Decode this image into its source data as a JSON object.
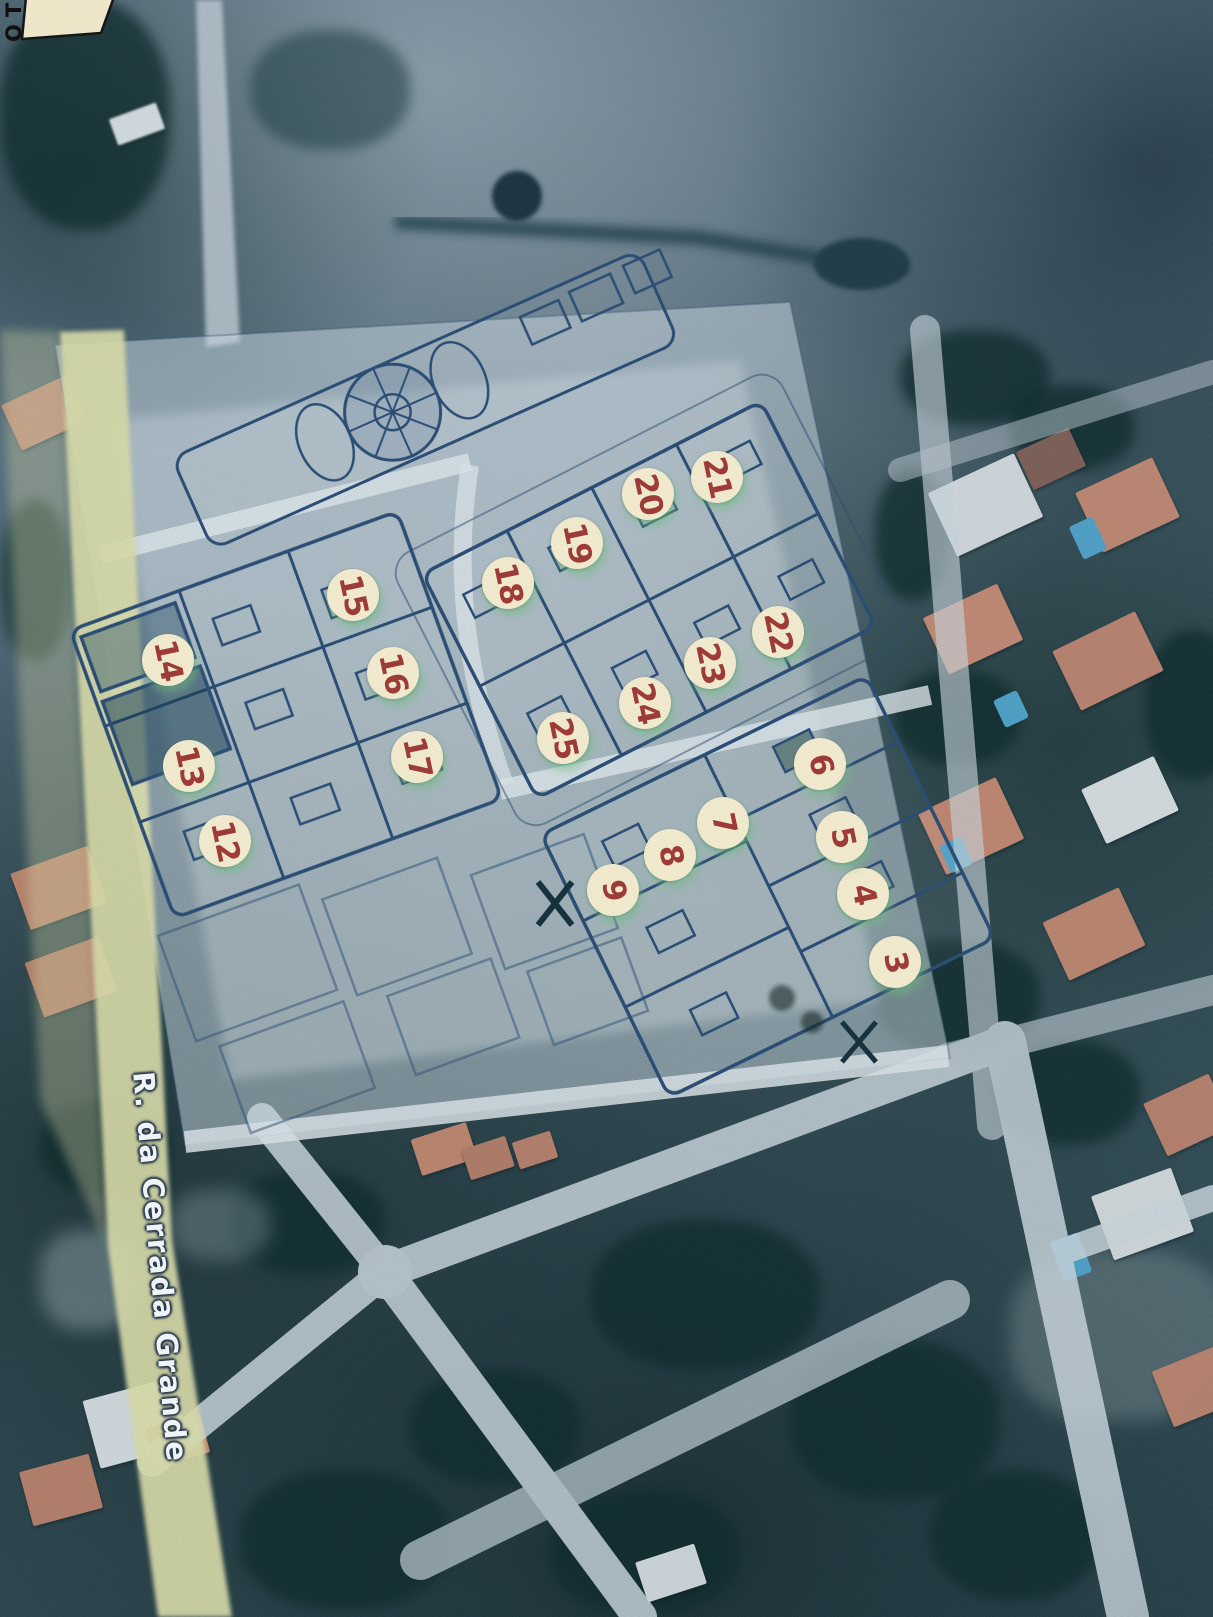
{
  "corner_label": {
    "text": "TO"
  },
  "street_label": {
    "text": "R. da Cerrada Grande"
  },
  "markers": [
    {
      "number": "3",
      "x": 895,
      "y": 962
    },
    {
      "number": "4",
      "x": 863,
      "y": 894
    },
    {
      "number": "5",
      "x": 842,
      "y": 837
    },
    {
      "number": "6",
      "x": 820,
      "y": 764
    },
    {
      "number": "7",
      "x": 723,
      "y": 823
    },
    {
      "number": "8",
      "x": 670,
      "y": 855
    },
    {
      "number": "9",
      "x": 613,
      "y": 890
    },
    {
      "number": "12",
      "x": 225,
      "y": 841
    },
    {
      "number": "13",
      "x": 189,
      "y": 766
    },
    {
      "number": "14",
      "x": 168,
      "y": 660
    },
    {
      "number": "15",
      "x": 353,
      "y": 595
    },
    {
      "number": "16",
      "x": 393,
      "y": 673
    },
    {
      "number": "17",
      "x": 417,
      "y": 757
    },
    {
      "number": "18",
      "x": 508,
      "y": 583
    },
    {
      "number": "19",
      "x": 577,
      "y": 543
    },
    {
      "number": "20",
      "x": 648,
      "y": 494
    },
    {
      "number": "21",
      "x": 717,
      "y": 477
    },
    {
      "number": "22",
      "x": 778,
      "y": 632
    },
    {
      "number": "23",
      "x": 710,
      "y": 663
    },
    {
      "number": "24",
      "x": 645,
      "y": 703
    },
    {
      "number": "25",
      "x": 563,
      "y": 738
    }
  ],
  "colors": {
    "marker_bg": "#f2ebcf",
    "marker_ink": "#9e3a37",
    "marker_glow": "#6fbe82",
    "street_ink": "#f3f6f8",
    "road_yellow": "#d6d9a8",
    "plan_ink": "#2b4d74",
    "label_bg": "#efe8cb",
    "pool": "#4f9fc4"
  }
}
